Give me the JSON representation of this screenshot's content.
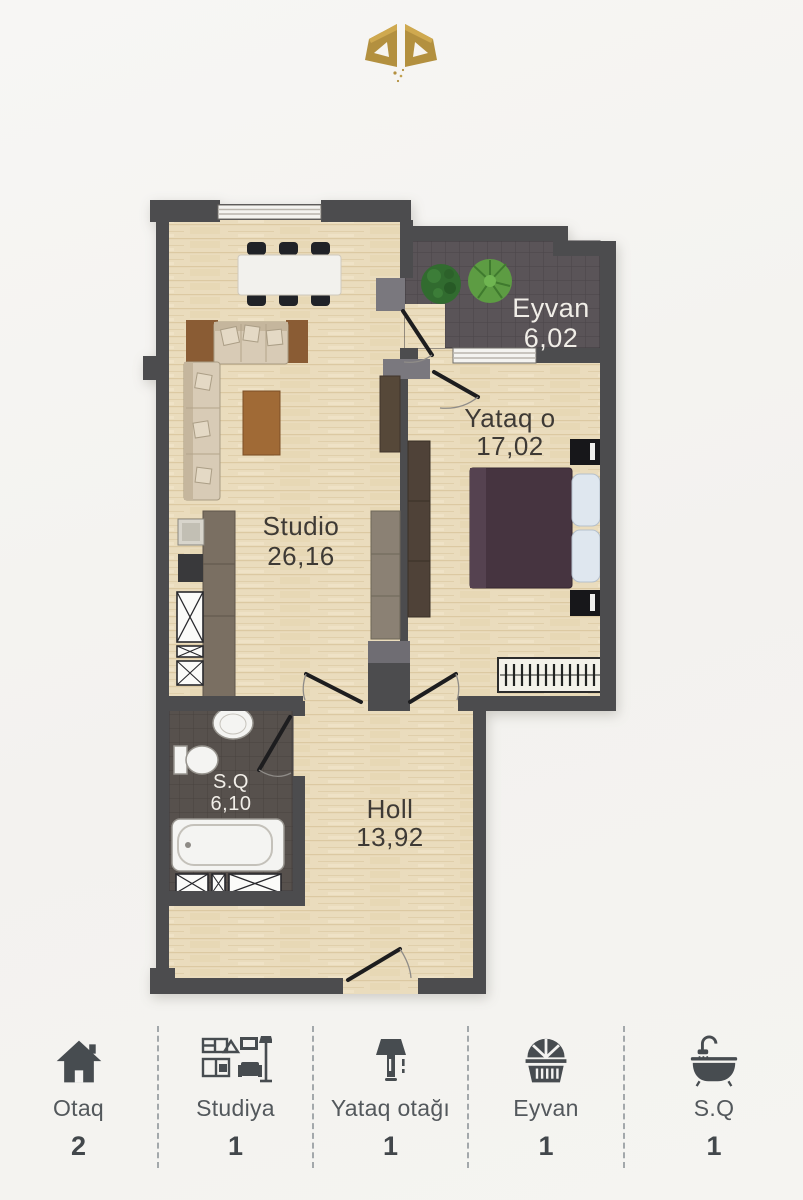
{
  "rooms": {
    "studio": {
      "label": "Studio",
      "area": "26,16"
    },
    "yataq": {
      "label": "Yataq o",
      "area": "17,02"
    },
    "eyvan": {
      "label": "Eyvan",
      "area": "6,02"
    },
    "holl": {
      "label": "Holl",
      "area": "13,92"
    },
    "sq": {
      "label": "S.Q",
      "area": "6,10"
    }
  },
  "legend": {
    "items": [
      {
        "label": "Otaq",
        "count": "2",
        "icon": "house-icon"
      },
      {
        "label": "Studiya",
        "count": "1",
        "icon": "studio-furniture-icon"
      },
      {
        "label": "Yataq otağı",
        "count": "1",
        "icon": "table-lamp-icon"
      },
      {
        "label": "Eyvan",
        "count": "1",
        "icon": "balcony-icon"
      },
      {
        "label": "S.Q",
        "count": "1",
        "icon": "bathtub-icon"
      }
    ]
  },
  "colors": {
    "wall": "#4c4c4e",
    "floor": "#eadcbd",
    "tile": "#5a5458",
    "gold": "#b3903f",
    "bed": "#463440",
    "legend_icon": "#474c50",
    "label_dark": "#3e3a35",
    "label_light": "#f1eee8"
  }
}
